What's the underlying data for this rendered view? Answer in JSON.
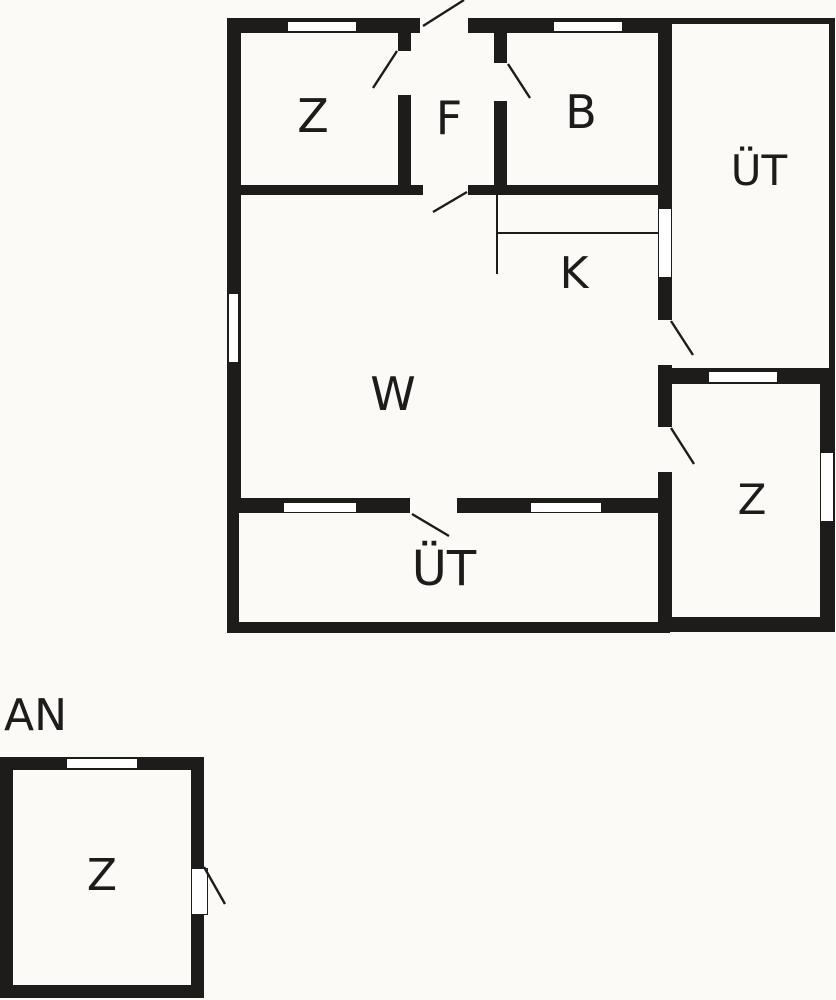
{
  "colors": {
    "wall": "#1d1c1b",
    "background": "#fbfaf7",
    "window_fill": "#ffffff",
    "label": "#1d1c1b"
  },
  "buildings": {
    "main": {
      "rooms": {
        "z_top_left": {
          "label": "Z"
        },
        "f_hall": {
          "label": "F"
        },
        "b_bath": {
          "label": "B"
        },
        "ut_terrace_right": {
          "label": "ÜT"
        },
        "k_kitchen": {
          "label": "K"
        },
        "w_living": {
          "label": "W"
        },
        "z_bottom_right": {
          "label": "Z"
        },
        "ut_terrace_bottom": {
          "label": "ÜT"
        }
      }
    },
    "annex": {
      "label": "AN",
      "rooms": {
        "z_annex": {
          "label": "Z"
        }
      }
    }
  }
}
